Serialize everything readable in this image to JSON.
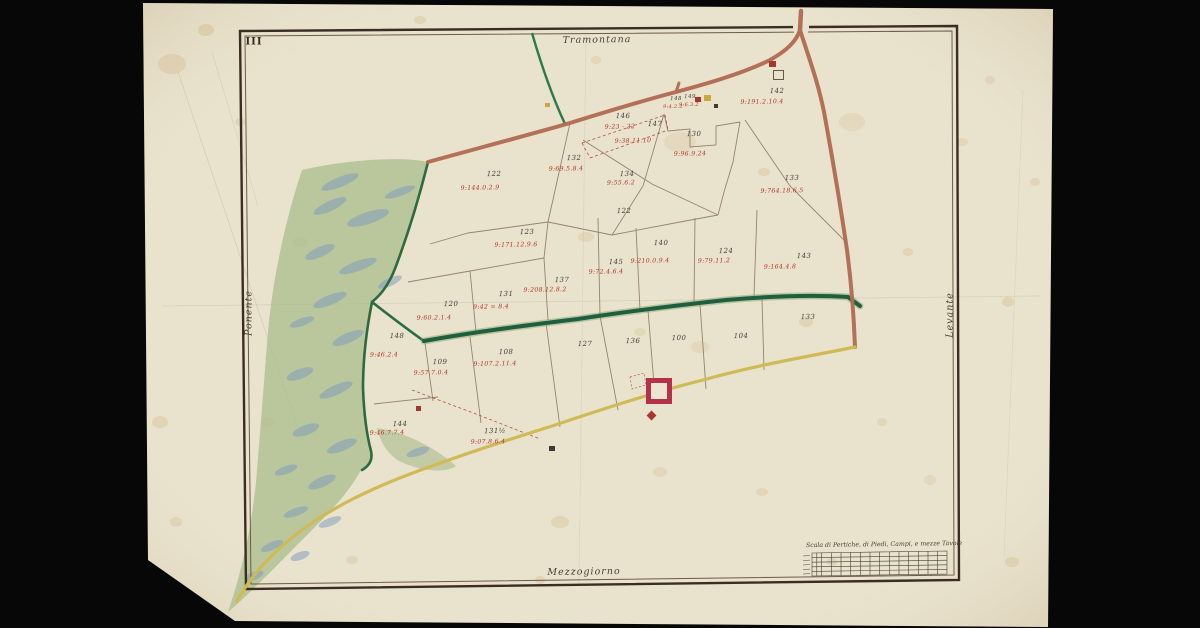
{
  "map": {
    "sheet_number": "III",
    "cardinal_labels": {
      "top": "Tramontana",
      "bottom": "Mezzogiorno",
      "left": "Ponente",
      "right": "Levante"
    },
    "scale_table": {
      "title": "Scala di Pertiche, di Piedi, Campi, e mezze Tavole"
    },
    "colors": {
      "paper": "#eae3cf",
      "ink_red": "#b0382a",
      "ink_black": "#46403a",
      "road_brown": "#b06a52",
      "road_yellow": "#cfba55",
      "canal_green": "#1f5f3f",
      "forest_green": "#a9bd8c",
      "forest_blue": "#7e9bbd",
      "border_brown": "#35291f",
      "fort_red": "#b5314a"
    },
    "parcels": [
      {
        "number": "146",
        "x": 623,
        "y": 116,
        "annotation": "9:23 - 22",
        "ax": 620,
        "ay": 127
      },
      {
        "number": "147",
        "x": 655,
        "y": 124,
        "annotation": "9:38.11.10",
        "ax": 633,
        "ay": 141
      },
      {
        "number": "148",
        "x": 676,
        "y": 99,
        "annotation": "9:4.2.2",
        "ax": 673,
        "ay": 107,
        "tiny": true
      },
      {
        "number": "149",
        "x": 690,
        "y": 97,
        "annotation": "9:6.3.2",
        "ax": 689,
        "ay": 105,
        "tiny": true
      },
      {
        "number": "130",
        "x": 694,
        "y": 134,
        "annotation": "9:96.9.24",
        "ax": 690,
        "ay": 154
      },
      {
        "number": "142",
        "x": 777,
        "y": 91,
        "annotation": "9:191.2.10.4",
        "ax": 762,
        "ay": 102
      },
      {
        "number": "122",
        "x": 494,
        "y": 174,
        "annotation": "9:144.0.2.9",
        "ax": 480,
        "ay": 188
      },
      {
        "number": "132",
        "x": 574,
        "y": 158,
        "annotation": "9:69.5.8.4",
        "ax": 566,
        "ay": 169
      },
      {
        "number": "134",
        "x": 627,
        "y": 174,
        "annotation": "9:55.6.2",
        "ax": 621,
        "ay": 183
      },
      {
        "number": "122",
        "x": 624,
        "y": 211
      },
      {
        "number": "133",
        "x": 792,
        "y": 178,
        "annotation": "9:764.18.6.5",
        "ax": 782,
        "ay": 191
      },
      {
        "number": "123",
        "x": 527,
        "y": 232,
        "annotation": "9:171.12.9.6",
        "ax": 516,
        "ay": 245
      },
      {
        "number": "120",
        "x": 451,
        "y": 304,
        "annotation": "9:60.2.1.4",
        "ax": 434,
        "ay": 318
      },
      {
        "number": "131",
        "x": 506,
        "y": 294,
        "annotation": "9:42 = 8.4",
        "ax": 491,
        "ay": 307
      },
      {
        "number": "137",
        "x": 562,
        "y": 280,
        "annotation": "9:208.12.8.2",
        "ax": 545,
        "ay": 290
      },
      {
        "number": "145",
        "x": 616,
        "y": 262,
        "annotation": "9:72.4.6.4",
        "ax": 606,
        "ay": 272
      },
      {
        "number": "140",
        "x": 661,
        "y": 243,
        "annotation": "9:210.0.9.4",
        "ax": 650,
        "ay": 261
      },
      {
        "number": "124",
        "x": 726,
        "y": 251,
        "annotation": "9:79.11.2",
        "ax": 714,
        "ay": 261
      },
      {
        "number": "143",
        "x": 804,
        "y": 256,
        "annotation": "9:164.4.8",
        "ax": 780,
        "ay": 267
      },
      {
        "number": "133",
        "x": 808,
        "y": 317
      },
      {
        "number": "127",
        "x": 585,
        "y": 344
      },
      {
        "number": "136",
        "x": 633,
        "y": 341
      },
      {
        "number": "100",
        "x": 679,
        "y": 338
      },
      {
        "number": "104",
        "x": 741,
        "y": 336
      },
      {
        "number": "148",
        "x": 397,
        "y": 336,
        "annotation": "9:46.2.4",
        "ax": 384,
        "ay": 355
      },
      {
        "number": "109",
        "x": 440,
        "y": 362,
        "annotation": "9:57.7.0.4",
        "ax": 431,
        "ay": 373
      },
      {
        "number": "108",
        "x": 506,
        "y": 352,
        "annotation": "9:107.2.11.4",
        "ax": 495,
        "ay": 364
      },
      {
        "number": "144",
        "x": 400,
        "y": 424,
        "annotation": "9:46.7.7.4",
        "ax": 387,
        "ay": 433
      },
      {
        "number": "131½",
        "x": 495,
        "y": 431,
        "annotation": "9:07.8.6.4",
        "ax": 488,
        "ay": 442
      }
    ],
    "buildings": [
      {
        "type": "fort",
        "x": 646,
        "y": 378,
        "size": 16
      },
      {
        "type": "marker-dot",
        "x": 648,
        "y": 412,
        "w": 7,
        "h": 7,
        "color": "#a8352f"
      },
      {
        "type": "house",
        "x": 769,
        "y": 61,
        "w": 7,
        "h": 6,
        "color": "#a8352f"
      },
      {
        "type": "house-outline",
        "x": 773,
        "y": 70,
        "w": 9,
        "h": 8,
        "color": "#6b5844"
      },
      {
        "type": "house",
        "x": 695,
        "y": 97,
        "w": 6,
        "h": 5,
        "color": "#a8352f"
      },
      {
        "type": "house",
        "x": 704,
        "y": 95,
        "w": 7,
        "h": 6,
        "color": "#c9a83c"
      },
      {
        "type": "house",
        "x": 714,
        "y": 104,
        "w": 4,
        "h": 4,
        "color": "#3f3a34"
      },
      {
        "type": "house",
        "x": 549,
        "y": 446,
        "w": 6,
        "h": 5,
        "color": "#3f3a34"
      },
      {
        "type": "house",
        "x": 416,
        "y": 406,
        "w": 5,
        "h": 5,
        "color": "#a8352f"
      },
      {
        "type": "house",
        "x": 545,
        "y": 103,
        "w": 5,
        "h": 4,
        "color": "#c9a83c"
      }
    ]
  }
}
